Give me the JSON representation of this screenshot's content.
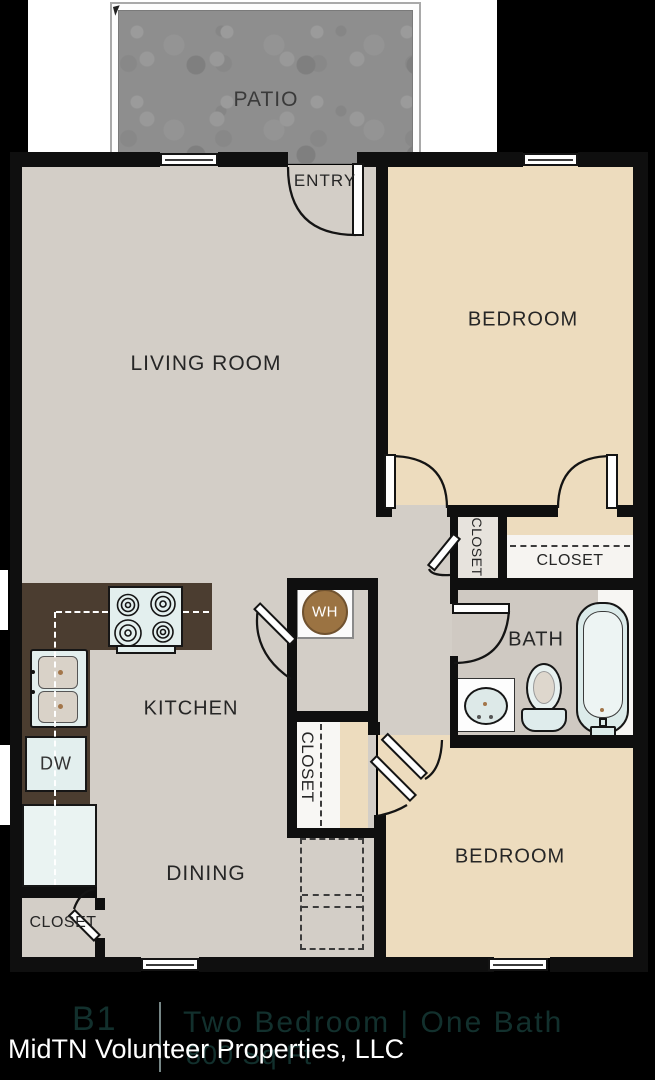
{
  "rooms": {
    "patio": "PATIO",
    "entry": "ENTRY",
    "living_room": "LIVING ROOM",
    "bedroom_top": "BEDROOM",
    "bedroom_bottom": "BEDROOM",
    "kitchen": "KITCHEN",
    "dining": "DINING",
    "bath": "BATH"
  },
  "closets": {
    "hall_closet": "CLOSET",
    "bedroom_closet": "CLOSET",
    "center_closet": "CLOSET",
    "entry_closet": "CLOSET"
  },
  "appliances": {
    "dishwasher": "DW",
    "water_heater": "WH"
  },
  "footer": {
    "plan_code": "B1",
    "plan_name": "Two Bedroom | One Bath",
    "area": "800 Sq Ft",
    "company": "MidTN Volunteer Properties, LLC"
  },
  "colors": {
    "wall": "#0f0f0f",
    "floor_gray": "#d3cec7",
    "bedroom_tan": "#eddcbe",
    "bath_gray": "#cfc9c2",
    "counter_brown": "#4b3d30",
    "fixture_light": "#e3efee",
    "water_heater_brown": "#9b7342",
    "patio_gray": "#8e8e8e",
    "background": "#000000",
    "footer_text_dim": "#12302d",
    "footer_text_white": "#ffffff"
  }
}
